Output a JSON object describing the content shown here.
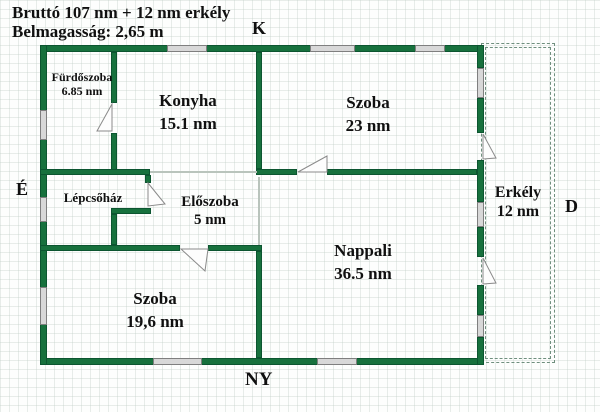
{
  "header": {
    "line1": "Bruttó 107 nm + 12 nm erkély",
    "line2": "Belmagasság: 2,65 m"
  },
  "compass": {
    "top": "K",
    "left": "É",
    "right": "D",
    "bottom": "NY"
  },
  "rooms": [
    {
      "name": "Fürdőszoba",
      "area": "6.85 nm"
    },
    {
      "name": "Konyha",
      "area": "15.1 nm"
    },
    {
      "name": "Szoba",
      "area": "23 nm"
    },
    {
      "name": "Lépcsőház",
      "area": ""
    },
    {
      "name": "Előszoba",
      "area": "5 nm"
    },
    {
      "name": "Nappali",
      "area": "36.5 nm"
    },
    {
      "name": "Szoba",
      "area": "19,6 nm"
    },
    {
      "name": "Erkély",
      "area": "12 nm"
    }
  ],
  "colors": {
    "wall_green": "#17713d",
    "window_gray": "#d8d8d8",
    "balcony_dash": "#6f8f7e"
  }
}
